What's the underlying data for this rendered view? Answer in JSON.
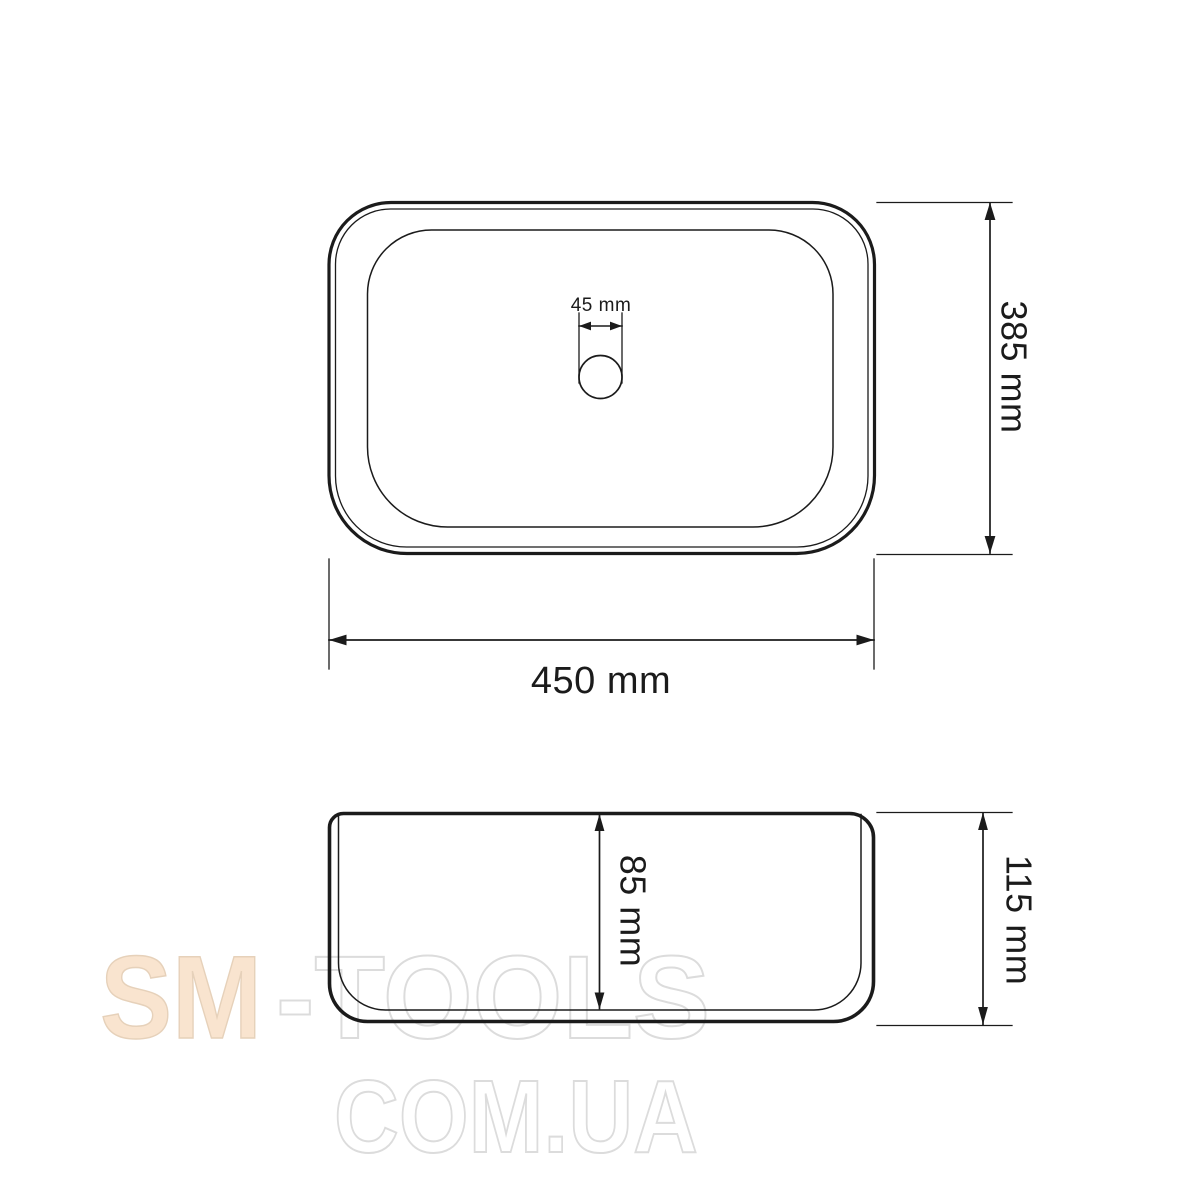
{
  "colors": {
    "line": "#1b1b1b",
    "background": "#ffffff",
    "watermark_fill": "#f9e4cf",
    "watermark_fill_stroke": "#e6d1ba",
    "watermark_outline": "#dcdcdc"
  },
  "dimensions": {
    "drain_diameter": {
      "label": "45 mm",
      "value": 45,
      "unit": "mm"
    },
    "basin_depth": {
      "label": "385 mm",
      "value": 385,
      "unit": "mm"
    },
    "basin_width": {
      "label": "450 mm",
      "value": 450,
      "unit": "mm"
    },
    "inner_height": {
      "label": "85 mm",
      "value": 85,
      "unit": "mm"
    },
    "total_height": {
      "label": "115 mm",
      "value": 115,
      "unit": "mm"
    }
  },
  "watermark": {
    "brand_primary": "SM",
    "brand_secondary": "-TOOLS",
    "domain": "COM.UA"
  }
}
